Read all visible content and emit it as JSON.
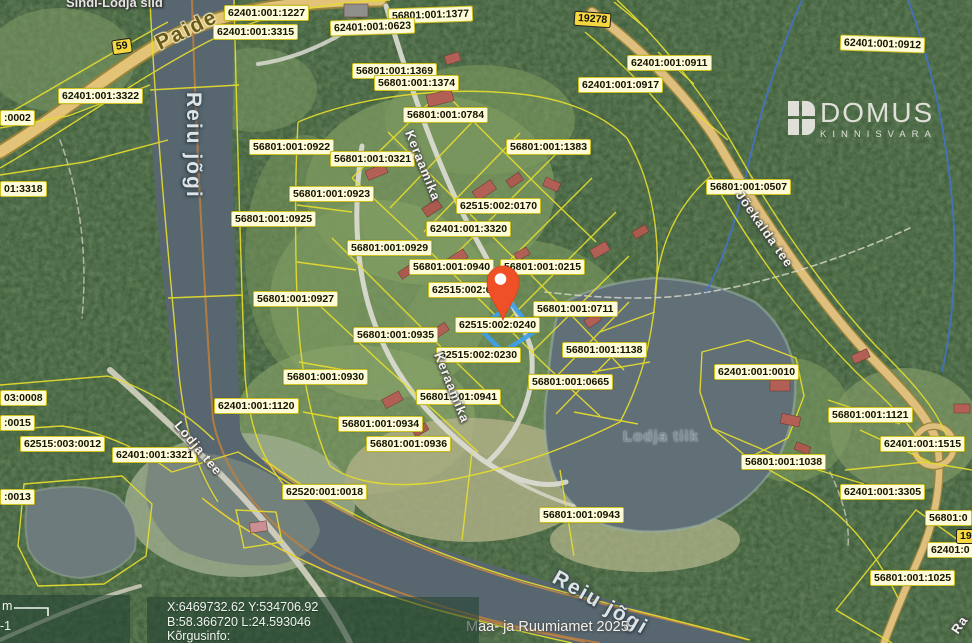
{
  "window": {
    "width": 972,
    "height": 643,
    "app": "cadastral-web-map"
  },
  "map": {
    "attribution": "Maa- ja Ruumiamet 2025",
    "parcel_labels": [
      {
        "text": "62401:001:1227",
        "x": 224,
        "y": 5
      },
      {
        "text": "56801:001:1377",
        "x": 388,
        "y": 7,
        "rot": -2
      },
      {
        "text": "62401:001:3315",
        "x": 213,
        "y": 24
      },
      {
        "text": "62401:001:0623",
        "x": 330,
        "y": 19,
        "rot": -2
      },
      {
        "text": "62401:001:0912",
        "x": 840,
        "y": 36,
        "rot": 2
      },
      {
        "text": "62401:001:0911",
        "x": 627,
        "y": 55
      },
      {
        "text": "56801:001:1369",
        "x": 352,
        "y": 63
      },
      {
        "text": "62401:001:0917",
        "x": 578,
        "y": 77
      },
      {
        "text": "56801:001:1374",
        "x": 374,
        "y": 75
      },
      {
        "text": "62401:001:3322",
        "x": 58,
        "y": 88
      },
      {
        "text": "56801:001:0784",
        "x": 403,
        "y": 107
      },
      {
        "text": "56801:001:0922",
        "x": 249,
        "y": 139
      },
      {
        "text": "56801:001:1383",
        "x": 506,
        "y": 139
      },
      {
        "text": "56801:001:0321",
        "x": 330,
        "y": 151
      },
      {
        "text": "56801:001:0507",
        "x": 706,
        "y": 179
      },
      {
        "text": "56801:001:0923",
        "x": 289,
        "y": 186
      },
      {
        "text": "62515:002:0170",
        "x": 456,
        "y": 198
      },
      {
        "text": "56801:001:0925",
        "x": 231,
        "y": 211
      },
      {
        "text": "62401:001:3320",
        "x": 426,
        "y": 221
      },
      {
        "text": "56801:001:0929",
        "x": 347,
        "y": 240
      },
      {
        "text": "56801:001:0940",
        "x": 409,
        "y": 259
      },
      {
        "text": "56801:001:0215",
        "x": 500,
        "y": 259
      },
      {
        "text": "62515:002:0190",
        "x": 428,
        "y": 282
      },
      {
        "text": "56801:001:0927",
        "x": 253,
        "y": 291
      },
      {
        "text": "56801:001:0711",
        "x": 533,
        "y": 301
      },
      {
        "text": "62515:002:0240",
        "x": 455,
        "y": 317
      },
      {
        "text": "56801:001:0935",
        "x": 353,
        "y": 327
      },
      {
        "text": "56801:001:1138",
        "x": 562,
        "y": 342
      },
      {
        "text": "62515:002:0230",
        "x": 436,
        "y": 347
      },
      {
        "text": "62401:001:0010",
        "x": 714,
        "y": 364
      },
      {
        "text": "56801:001:0930",
        "x": 283,
        "y": 369
      },
      {
        "text": "56801:001:0665",
        "x": 528,
        "y": 374
      },
      {
        "text": "56801:001:0941",
        "x": 416,
        "y": 389
      },
      {
        "text": "62401:001:1120",
        "x": 214,
        "y": 398
      },
      {
        "text": "56801:001:1121",
        "x": 828,
        "y": 407
      },
      {
        "text": "56801:001:0934",
        "x": 338,
        "y": 416
      },
      {
        "text": "62515:003:0012",
        "x": 20,
        "y": 436
      },
      {
        "text": "56801:001:0936",
        "x": 366,
        "y": 436
      },
      {
        "text": "62401:001:1515",
        "x": 880,
        "y": 436
      },
      {
        "text": "62401:001:3321",
        "x": 112,
        "y": 447
      },
      {
        "text": "56801:001:1038",
        "x": 741,
        "y": 454
      },
      {
        "text": "62520:001:0018",
        "x": 282,
        "y": 484
      },
      {
        "text": "62401:001:3305",
        "x": 840,
        "y": 484
      },
      {
        "text": "56801:001:0943",
        "x": 539,
        "y": 507
      },
      {
        "text": "56801:001:1025",
        "x": 870,
        "y": 570
      },
      {
        "text": ":0002",
        "x": 0,
        "y": 110
      },
      {
        "text": "01:3318",
        "x": 0,
        "y": 181
      },
      {
        "text": "03:0008",
        "x": 0,
        "y": 390
      },
      {
        "text": ":0015",
        "x": 0,
        "y": 415
      },
      {
        "text": ":0013",
        "x": 0,
        "y": 489
      },
      {
        "text": "56801:0",
        "x": 925,
        "y": 510
      },
      {
        "text": "62401:0",
        "x": 927,
        "y": 542
      }
    ],
    "road_number_badges": [
      {
        "text": "59",
        "x": 112,
        "y": 39,
        "rot": -8
      },
      {
        "text": "19278",
        "x": 574,
        "y": 12,
        "rot": 4
      },
      {
        "text": "19",
        "x": 956,
        "y": 529,
        "rot": 0
      }
    ],
    "place_labels": [
      {
        "text": "Sindi-Lodja sild",
        "x": 66,
        "y": -5,
        "style": "place",
        "rot": 0
      },
      {
        "text": "Paide",
        "x": 152,
        "y": 34,
        "style": "road-name",
        "rot": -26
      },
      {
        "text": "Reiu jõgi",
        "x": 205,
        "y": 92,
        "style": "water-big",
        "rot": 90
      },
      {
        "text": "Keraamika",
        "x": 416,
        "y": 128,
        "style": "street",
        "rot": 68
      },
      {
        "text": "Keraamika",
        "x": 445,
        "y": 350,
        "style": "street",
        "rot": 68
      },
      {
        "text": "Jõekalda tee",
        "x": 745,
        "y": 188,
        "style": "street",
        "rot": 55
      },
      {
        "text": "Lodja tee",
        "x": 183,
        "y": 418,
        "style": "street",
        "rot": 50
      },
      {
        "text": "Lodja tiik",
        "x": 623,
        "y": 428,
        "style": "water-small",
        "rot": 0
      },
      {
        "text": "Reiu jõgi",
        "x": 560,
        "y": 566,
        "style": "water-big",
        "rot": 30
      },
      {
        "text": "Ra",
        "x": 948,
        "y": 628,
        "style": "street",
        "rot": -55
      }
    ],
    "marker": {
      "label": "location-pin",
      "color": "#f05026"
    },
    "selection_color": "#3fa0e8"
  },
  "overlays": {
    "logo": {
      "title": "DOMUS",
      "subtitle": "KINNISVARA"
    },
    "coordinates_panel": {
      "line1": "X:6469732.62 Y:534706.92",
      "line2": "B:58.366720 L:24.593046",
      "line3": "Kõrgusinfo:"
    },
    "scale_panel": {
      "unit_label": "m",
      "value_label": "-1"
    }
  },
  "colors": {
    "parcel_label_bg": "#fdfbd8",
    "parcel_label_border": "#cfc11f",
    "boundary_yellow": "#e6dd2e",
    "road_badge_bg": "#f7d93f",
    "water": "#5a6a74",
    "pin": "#f05026",
    "selection_blue": "#3fa0e8",
    "forest": "#33502e",
    "panel_bg": "rgba(34,66,50,0.58)"
  }
}
